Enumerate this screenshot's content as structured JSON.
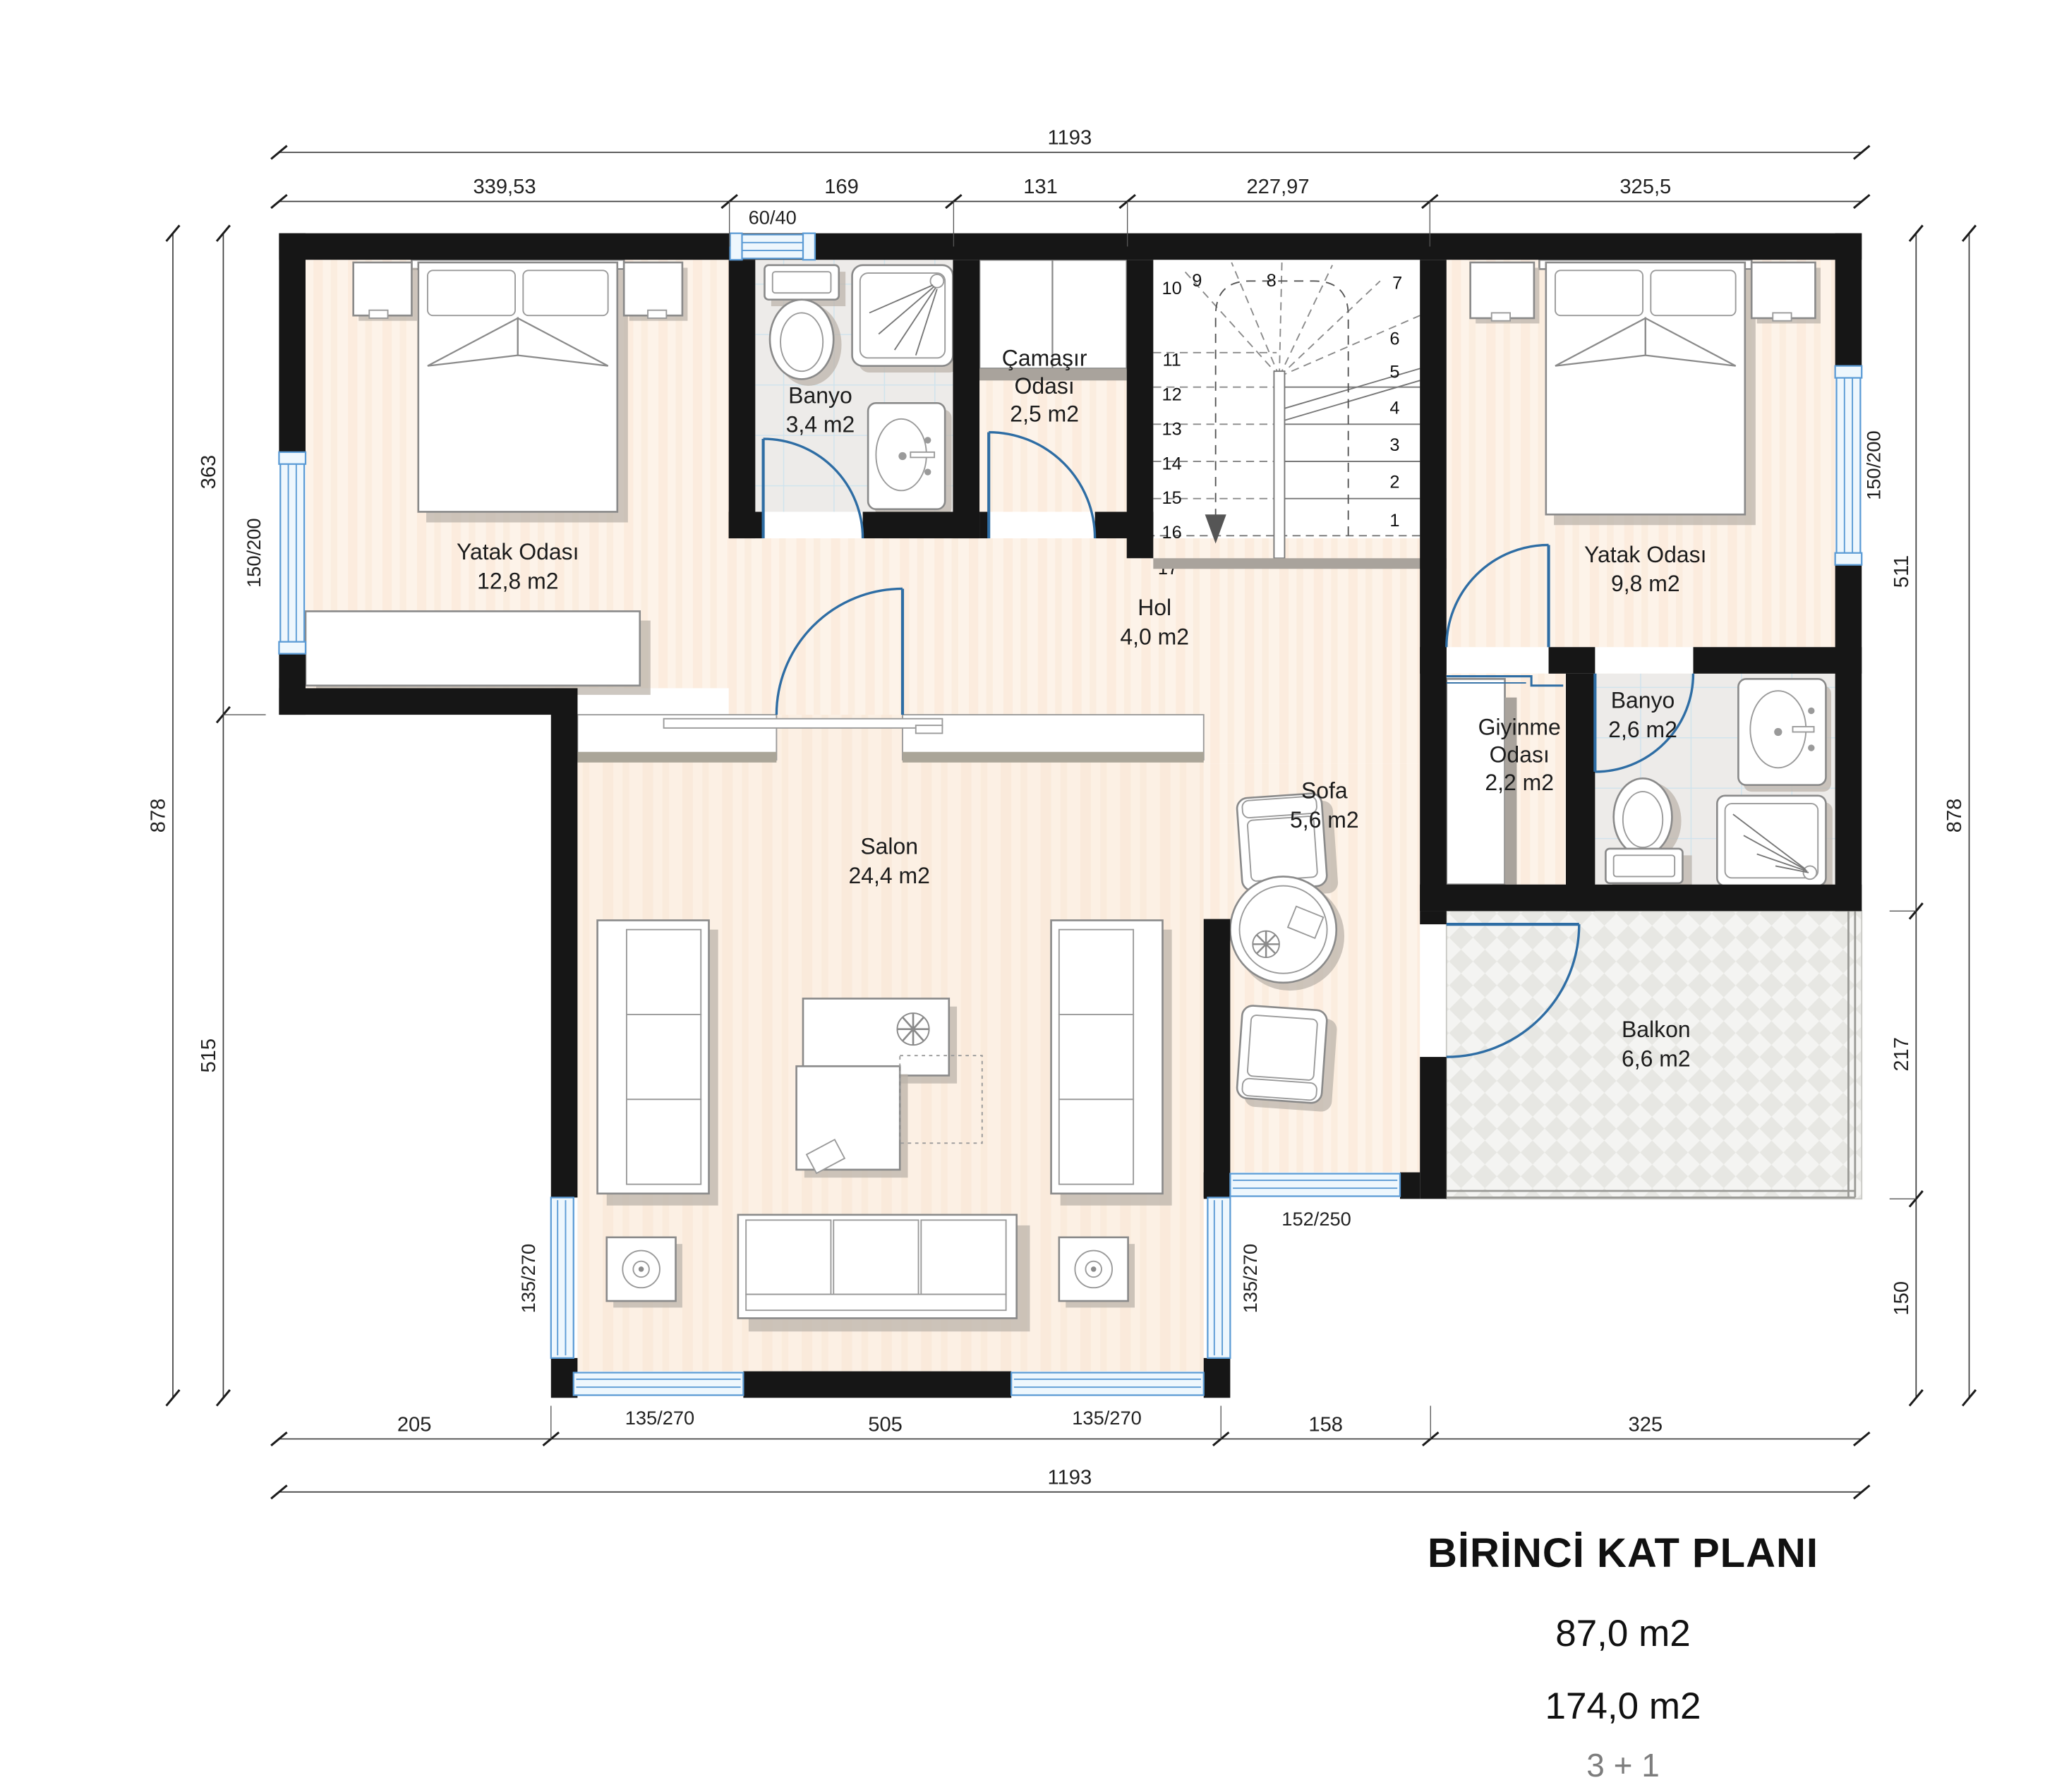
{
  "title_block": {
    "line1": "BİRİNCİ KAT PLANI",
    "line2": "87,0 m2",
    "line3": "174,0 m2",
    "line4": "3 + 1"
  },
  "rooms": {
    "bedroom_left": {
      "name": "Yatak Odası",
      "area": "12,8 m2"
    },
    "bathroom_top": {
      "name": "Banyo",
      "area": "3,4 m2"
    },
    "laundry": {
      "name": "Çamaşır",
      "name2": "Odası",
      "area": "2,5 m2"
    },
    "hall": {
      "name": "Hol",
      "area": "4,0 m2"
    },
    "bedroom_right": {
      "name": "Yatak Odası",
      "area": "9,8 m2"
    },
    "dressing": {
      "name": "Giyinme",
      "name2": "Odası",
      "area": "2,2 m2"
    },
    "bathroom_right": {
      "name": "Banyo",
      "area": "2,6 m2"
    },
    "living": {
      "name": "Salon",
      "area": "24,4 m2"
    },
    "sitting": {
      "name": "Sofa",
      "area": "5,6 m2"
    },
    "balcony": {
      "name": "Balkon",
      "area": "6,6 m2"
    }
  },
  "windows": {
    "left_bedroom": "150/200",
    "right_bedroom": "150/200",
    "bath_small": "60/40",
    "salon_left": "135/270",
    "salon_right": "135/270",
    "salon_bottom_left": "135/270",
    "salon_bottom_right": "135/270",
    "sofa_bottom": "152/250"
  },
  "dimensions": {
    "top_total": "1193",
    "top_segments": [
      "339,53",
      "169",
      "131",
      "227,97",
      "325,5"
    ],
    "bottom_segments": [
      "205",
      "505",
      "158",
      "325"
    ],
    "bottom_total": "1193",
    "left_outer": "878",
    "left_segments": [
      "363",
      "515"
    ],
    "right_segments": [
      "511",
      "217",
      "150"
    ],
    "right_outer": "878"
  },
  "stairs": {
    "numbers": [
      "1",
      "2",
      "3",
      "4",
      "5",
      "6",
      "7",
      "8",
      "9",
      "10",
      "11",
      "12",
      "13",
      "14",
      "15",
      "16",
      "17"
    ]
  }
}
